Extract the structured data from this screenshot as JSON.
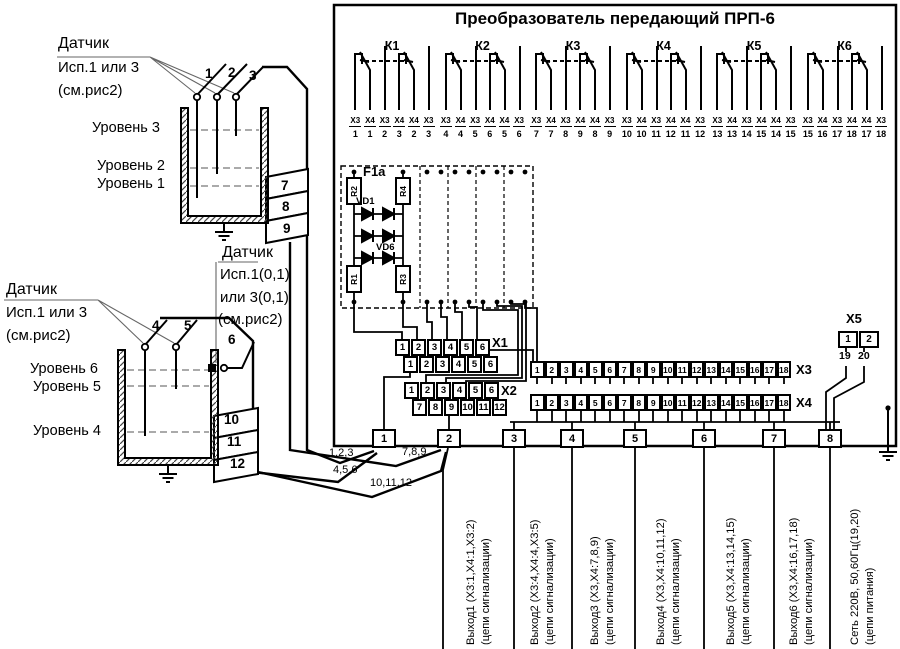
{
  "title": "Преобразователь передающий ПРП-6",
  "relays": [
    {
      "name": "К1",
      "c1": "Х3",
      "p1": "1",
      "c2": "Х4",
      "p2": "1",
      "c3": "Х3",
      "p3": "2",
      "c4": "Х4",
      "p4": "3",
      "c5": "Х4",
      "p5": "2",
      "c6": "Х3",
      "p6": "3"
    },
    {
      "name": "К2",
      "c1": "Х3",
      "p1": "4",
      "c2": "Х4",
      "p2": "4",
      "c3": "Х3",
      "p3": "5",
      "c4": "Х4",
      "p4": "6",
      "c5": "Х4",
      "p5": "5",
      "c6": "Х3",
      "p6": "6"
    },
    {
      "name": "К3",
      "c1": "Х3",
      "p1": "7",
      "c2": "Х4",
      "p2": "7",
      "c3": "Х3",
      "p3": "8",
      "c4": "Х4",
      "p4": "9",
      "c5": "Х4",
      "p5": "8",
      "c6": "Х3",
      "p6": "9"
    },
    {
      "name": "К4",
      "c1": "Х3",
      "p1": "10",
      "c2": "Х4",
      "p2": "10",
      "c3": "Х3",
      "p3": "11",
      "c4": "Х4",
      "p4": "12",
      "c5": "Х4",
      "p5": "11",
      "c6": "Х3",
      "p6": "12"
    },
    {
      "name": "К5",
      "c1": "Х3",
      "p1": "13",
      "c2": "Х4",
      "p2": "13",
      "c3": "Х3",
      "p3": "14",
      "c4": "Х4",
      "p4": "15",
      "c5": "Х4",
      "p5": "14",
      "c6": "Х3",
      "p6": "15"
    },
    {
      "name": "К6",
      "c1": "Х3",
      "p1": "15",
      "c2": "Х4",
      "p2": "16",
      "c3": "Х3",
      "p3": "17",
      "c4": "Х4",
      "p4": "18",
      "c5": "Х4",
      "p5": "17",
      "c6": "Х3",
      "p6": "18"
    }
  ],
  "fblock": {
    "label": "F1a",
    "vd_first": "VD1",
    "vd_last": "VD6",
    "r_top_left": "R2",
    "r_top_right": "R4",
    "r_bottom_left": "R1",
    "r_bottom_right": "R3"
  },
  "connectors": {
    "x1": {
      "label": "Х1",
      "row1": [
        "1",
        "2",
        "3",
        "4",
        "5",
        "6"
      ],
      "row2": [
        "1",
        "2",
        "3",
        "4",
        "5",
        "6"
      ]
    },
    "x2": {
      "label": "Х2",
      "row1": [
        "1",
        "2",
        "3",
        "4",
        "5",
        "6"
      ],
      "row2": [
        "7",
        "8",
        "9",
        "10",
        "11",
        "12"
      ]
    },
    "x3": {
      "label": "Х3",
      "pins": [
        "1",
        "2",
        "3",
        "4",
        "5",
        "6",
        "7",
        "8",
        "9",
        "10",
        "11",
        "12",
        "13",
        "14",
        "15",
        "16",
        "17",
        "18"
      ]
    },
    "x4": {
      "label": "Х4",
      "pins": [
        "1",
        "2",
        "3",
        "4",
        "5",
        "6",
        "7",
        "8",
        "9",
        "10",
        "11",
        "12",
        "13",
        "14",
        "15",
        "16",
        "17",
        "18"
      ]
    },
    "x5": {
      "label": "Х5",
      "pins": [
        "1",
        "2"
      ],
      "wire_numbers": [
        "19",
        "20"
      ]
    }
  },
  "glands": [
    "1",
    "2",
    "3",
    "4",
    "5",
    "6",
    "7",
    "8"
  ],
  "cables": {
    "c1": "1,2,3",
    "c2": "4,5,6",
    "c3": "7,8,9",
    "c4": "10,11,12"
  },
  "outputs": [
    {
      "line1": "Выход1 (Х3:1,Х4:1,Х3:2)",
      "line2": "(цепи сигнализации)"
    },
    {
      "line1": "Выход2 (Х3:4,Х4:4,Х3:5)",
      "line2": "(цепи сигнализации)"
    },
    {
      "line1": "Выход3 (Х3,Х4:7,8,9)",
      "line2": "(цепи сигнализации)"
    },
    {
      "line1": "Выход4 (Х3,Х4:10,11,12)",
      "line2": "(цепи сигнализации)"
    },
    {
      "line1": "Выход5 (Х3,Х4:13,14,15)",
      "line2": "(цепи сигнализации)"
    },
    {
      "line1": "Выход6 (Х3,Х4:16,17,18)",
      "line2": "(цепи сигнализации)"
    },
    {
      "line1": "Сеть 220В, 50,60Гц(19,20)",
      "line2": "(цепи питания)"
    }
  ],
  "sensor_top": {
    "name": "Датчик",
    "variant": "Исп.1 или 3",
    "ref": "(см.рис2)",
    "electrode_1": "1",
    "electrode_2": "2",
    "electrode_3": "3",
    "level_a": "Уровень 3",
    "level_b": "Уровень 2",
    "level_c": "Уровень 1",
    "wire_a": "7",
    "wire_b": "8",
    "wire_c": "9"
  },
  "sensor_bottom": {
    "name": "Датчик",
    "variant": "Исп.1 или 3",
    "ref": "(см.рис2)",
    "electrode_1": "4",
    "electrode_2": "5",
    "wire_6": "6",
    "level_a": "Уровень 6",
    "level_b": "Уровень 5",
    "level_c": "Уровень 4",
    "wire_a": "10",
    "wire_b": "11",
    "wire_c": "12"
  },
  "sensor_note": {
    "name": "Датчик",
    "variant1": "Исп.1(0,1)",
    "variant2": "или 3(0,1)",
    "ref": "(см.рис2)"
  }
}
